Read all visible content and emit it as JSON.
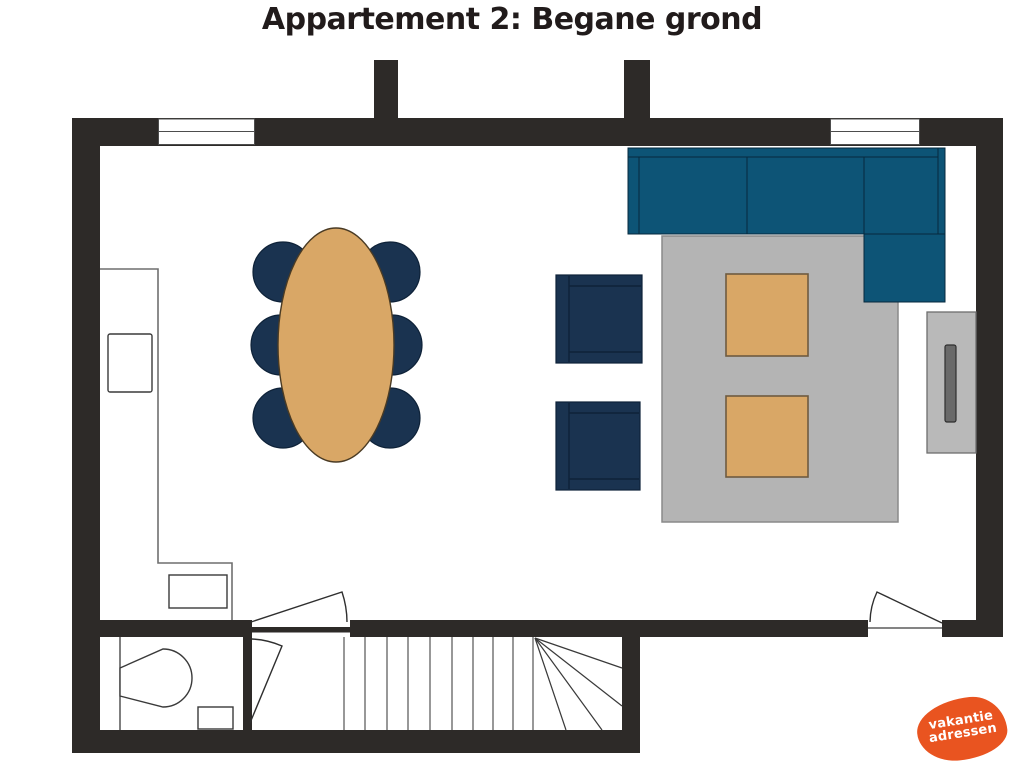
{
  "title": "Appartement 2: Begane grond",
  "logo": {
    "line1": "vakantie",
    "line2": "adressen",
    "bg_color": "#e95420",
    "text_color": "#ffffff"
  },
  "colors": {
    "background": "#ffffff",
    "title": "#211b1b",
    "wall": "#2d2a28",
    "sofa": "#0d5476",
    "chair": "#1a3350",
    "wood": "#d9a766",
    "rug": "#b4b4b4",
    "cabinet": "#b9b9b9",
    "tv": "#696969",
    "logo": "#e95420"
  },
  "plan": {
    "floor_label": "Begane grond (ground floor)",
    "elements": [
      "outer-walls",
      "chimney-stub",
      "chimney-stub",
      "window-top-left",
      "window-top-right",
      "door-hall-to-room",
      "door-hall-lower",
      "door-bottom-right",
      "kitchen-counter",
      "kitchen-appliance",
      "kitchen-sink",
      "dining-table-oval",
      "dining-chair",
      "dining-chair",
      "dining-chair",
      "dining-chair",
      "dining-chair",
      "dining-chair",
      "armchair",
      "armchair",
      "corner-sofa",
      "rug",
      "coffee-table",
      "coffee-table",
      "tv-cabinet",
      "tv",
      "toilet-room",
      "toilet",
      "toilet-bin",
      "staircase-with-winders"
    ]
  }
}
